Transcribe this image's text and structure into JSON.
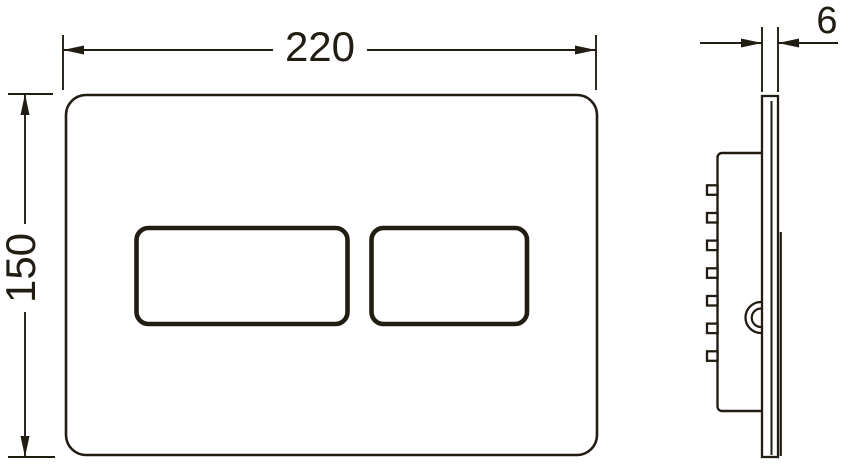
{
  "dimensions": {
    "width_label": "220",
    "height_label": "150",
    "thickness_label": "6"
  },
  "colors": {
    "line": "#221d12",
    "background": "#ffffff"
  }
}
